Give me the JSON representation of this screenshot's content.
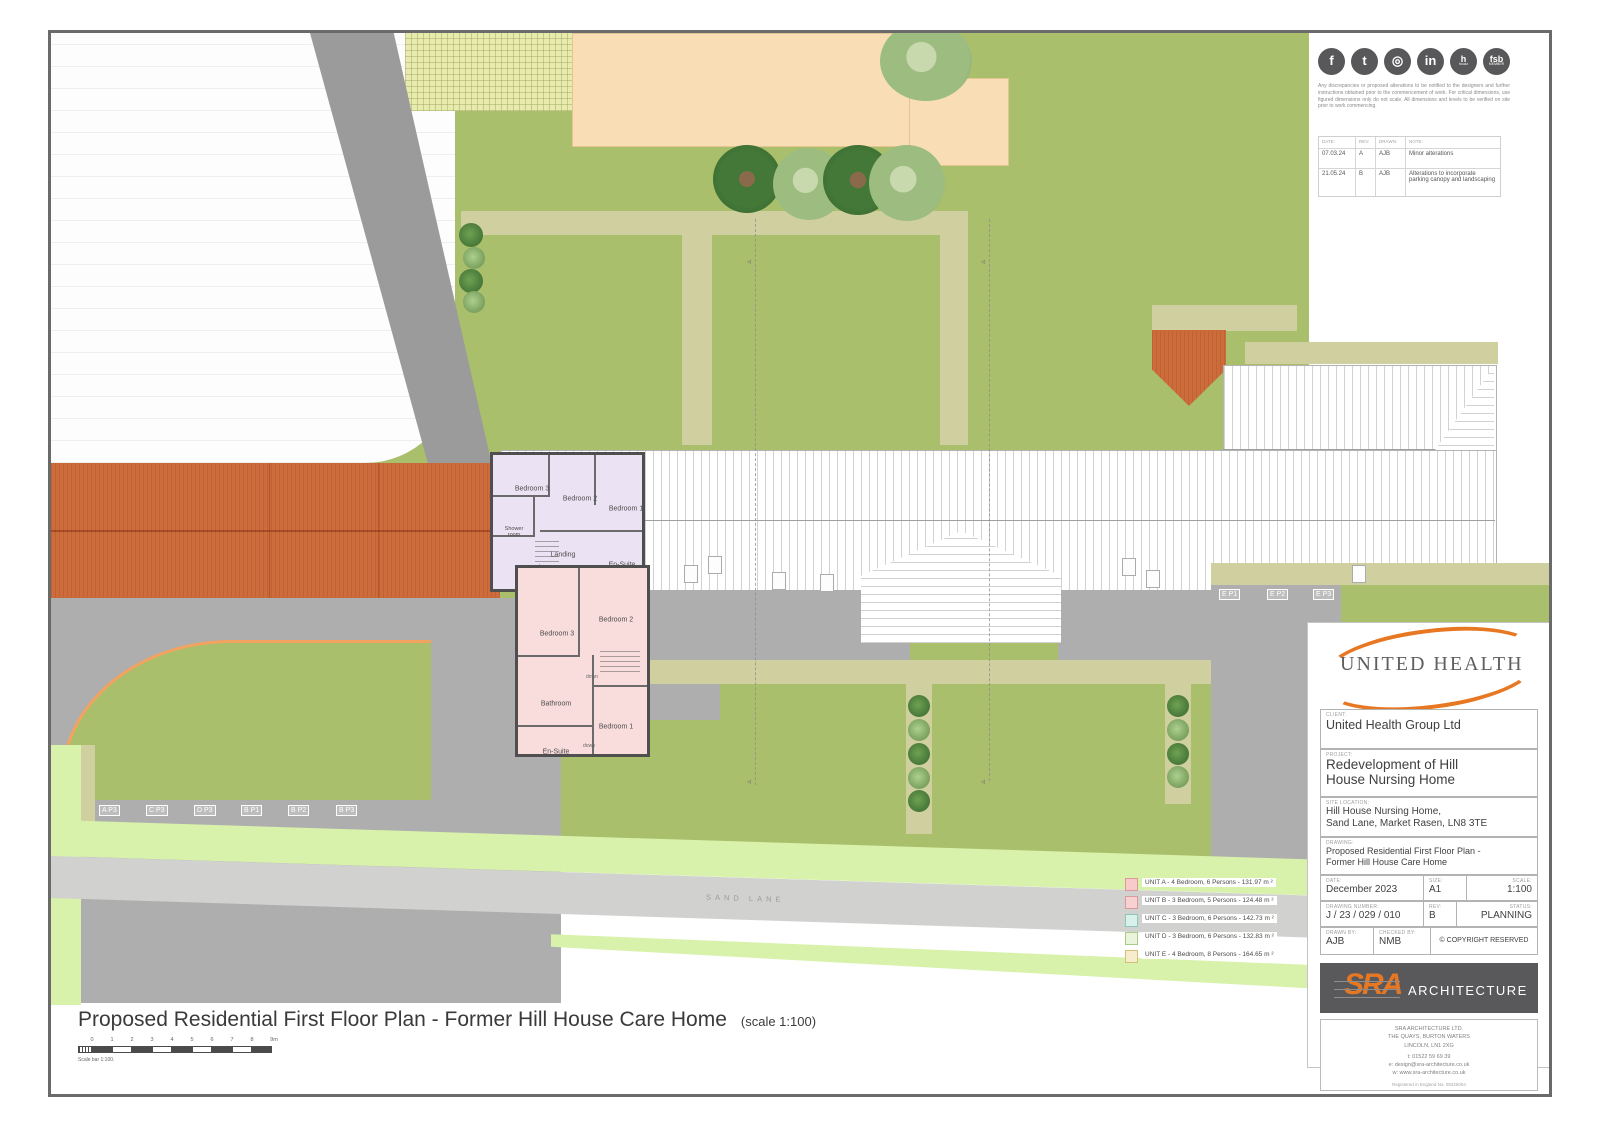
{
  "sheet": {
    "footer_title": "Proposed Residential First Floor Plan - Former Hill House Care Home",
    "footer_scale": "(scale 1:100)",
    "scale_bar_caption": "Scale bar 1:100.",
    "scale_ticks": [
      "0",
      "1",
      "2",
      "3",
      "4",
      "5",
      "6",
      "7",
      "8",
      "9m"
    ]
  },
  "palette": {
    "lawn": "#a9bf6c",
    "verge_green": "#d8f2ab",
    "path_khaki": "#cfcf9f",
    "tarmac_gray": "#aeaeae",
    "roof_tile_orange": "#ce6b3b",
    "unit_upper_fill": "#ebe3f3",
    "unit_lower_fill": "#f9dcdc",
    "accent_orange": "#e87722"
  },
  "notes": {
    "disclaimer": "Any discrepancies or proposed alterations to be notified to the designers and further instructions obtained prior to the commencement of work. For critical dimensions, use figured dimensions only do not scale. All dimensions and levels to be verified on site prior to work commencing.",
    "social": [
      {
        "name": "facebook",
        "glyph": "f"
      },
      {
        "name": "twitter",
        "glyph": "t"
      },
      {
        "name": "instagram",
        "glyph": "◎"
      },
      {
        "name": "linkedin",
        "glyph": "in"
      },
      {
        "name": "houzz",
        "glyph": "h",
        "sub": "houzz"
      },
      {
        "name": "fsb",
        "glyph": "fsb",
        "sub": "MEMBER"
      }
    ]
  },
  "revisions": {
    "headers": [
      "DATE:",
      "REV:",
      "DRAWN:",
      "NOTE:"
    ],
    "rows": [
      {
        "date": "07.03.24",
        "rev": "A",
        "drawn": "AJB",
        "note": "Minor alterations"
      },
      {
        "date": "21.05.24",
        "rev": "B",
        "drawn": "AJB",
        "note": "Alterations to incorporate parking canopy and landscaping"
      }
    ]
  },
  "title_block": {
    "logo_text": "UNITED HEALTH",
    "client_label": "CLIENT:",
    "client": "United Health Group Ltd",
    "project_label": "PROJECT:",
    "project_line1": "Redevelopment of Hill",
    "project_line2": "House Nursing Home",
    "site_label": "SITE LOCATION:",
    "site_line1": "Hill House Nursing Home,",
    "site_line2": "Sand Lane, Market Rasen, LN8 3TE",
    "drawing_label": "DRAWING:",
    "drawing_line1": "Proposed Residential First Floor Plan -",
    "drawing_line2": "Former Hill House Care Home",
    "date_label": "DATE:",
    "date": "December 2023",
    "size_label": "SIZE:",
    "size": "A1",
    "scale_label": "SCALE:",
    "scale": "1:100",
    "number_label": "DRAWING NUMBER:",
    "number": "J / 23 / 029 / 010",
    "rev_label": "REV:",
    "rev": "B",
    "status_label": "STATUS:",
    "status": "PLANNING",
    "drawn_by_label": "DRAWN BY:",
    "drawn_by": "AJB",
    "checked_by_label": "CHECKED BY:",
    "checked_by": "NMB",
    "copyright": "© COPYRIGHT RESERVED"
  },
  "architect": {
    "logo_sra": "SRA",
    "logo_word": "ARCHITECTURE",
    "address_line1": "SRA ARCHITECTURE LTD.",
    "address_line2": "THE QUAYS, BURTON WATERS",
    "address_line3": "LINCOLN, LN1 2XG",
    "phone": "t: 01522 59 69 39",
    "email": "e: design@sra-architecture.co.uk",
    "web": "w: www.sra-architecture.co.uk",
    "registered": "Registered in England No. 05325004"
  },
  "legend": {
    "items": [
      {
        "label": "UNIT A - 4 Bedroom, 6 Persons - 131.97 m ²",
        "color": "#f8caca",
        "border": "#d89a9a"
      },
      {
        "label": "UNIT B - 3 Bedroom, 5 Persons - 124.48 m ²",
        "color": "#f8d2d2",
        "border": "#d89a9a"
      },
      {
        "label": "UNIT C - 3 Bedroom, 6 Persons - 142.73 m ²",
        "color": "#d8f1ea",
        "border": "#8cc6bb"
      },
      {
        "label": "UNIT D - 3 Bedroom, 6 Persons - 132.83 m ²",
        "color": "#e9f4da",
        "border": "#a9cc8a"
      },
      {
        "label": "UNIT E - 4 Bedroom, 8 Persons - 164.65 m ²",
        "color": "#f7eccb",
        "border": "#d4bd7f"
      }
    ]
  },
  "plan": {
    "road_name": "SAND LANE",
    "parking_left": [
      "A P3",
      "C P3",
      "D P3",
      "B P1",
      "B P2",
      "B P3"
    ],
    "parking_right": [
      "E P1",
      "E P2",
      "E P3"
    ],
    "unit_upper": {
      "bedroom3": "Bedroom 3",
      "bedroom2": "Bedroom 2",
      "bedroom1": "Bedroom 1",
      "shower_line1": "Shower",
      "shower_line2": "room",
      "landing": "Landing",
      "down": "down",
      "ensuite": "En-Suite"
    },
    "unit_lower": {
      "bedroom3": "Bedroom 3",
      "bedroom2": "Bedroom 2",
      "bathroom": "Bathroom",
      "bedroom1": "Bedroom 1",
      "ensuite": "En-Suite",
      "down1": "down",
      "down2": "down"
    }
  }
}
